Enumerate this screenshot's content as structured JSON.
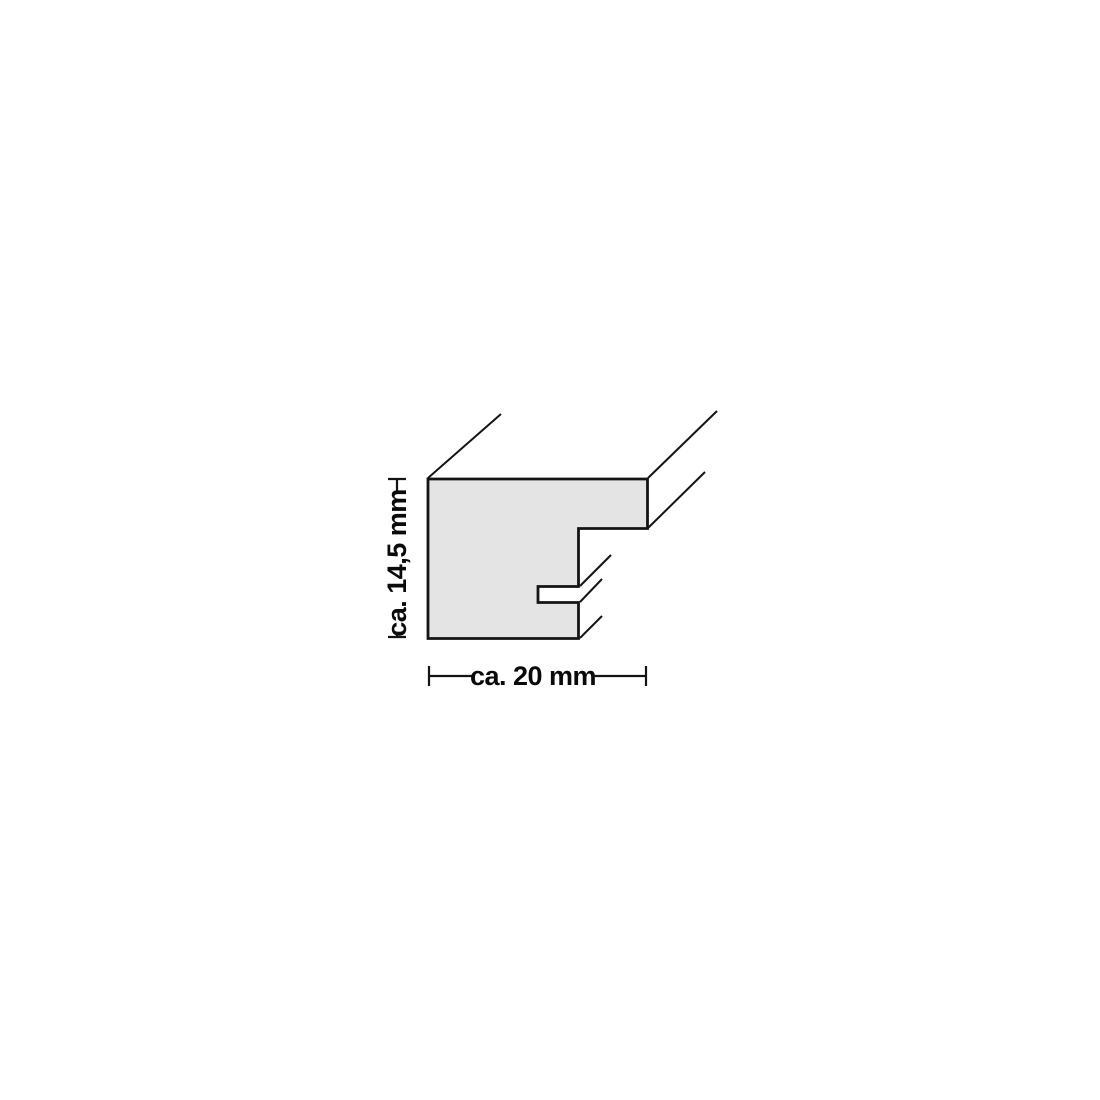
{
  "diagram": {
    "name": "picture-frame-profile-cross-section",
    "height_dimension": {
      "label": "ca. 14,5 mm"
    },
    "width_dimension": {
      "label": "ca. 20 mm"
    },
    "colors": {
      "profile_fill": "#e4e4e4",
      "line": "#141414",
      "background": "#ffffff"
    }
  }
}
